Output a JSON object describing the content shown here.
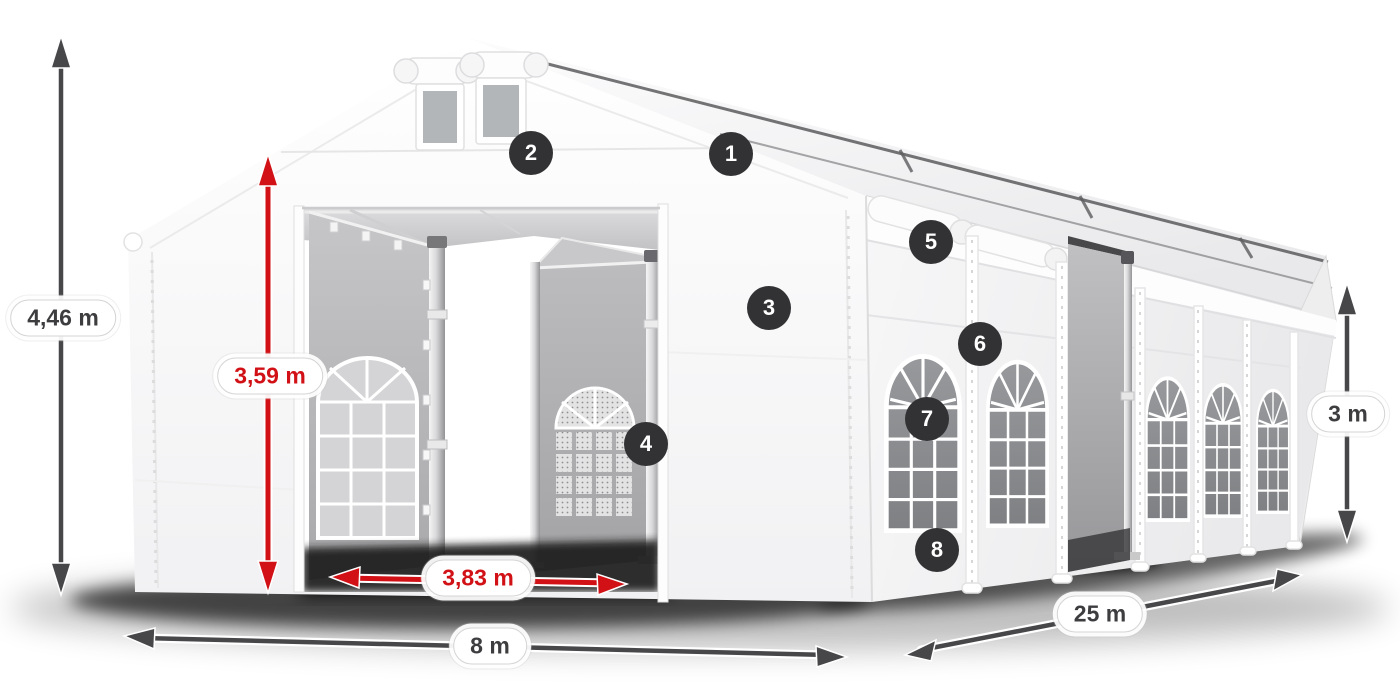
{
  "diagram": {
    "subject": "marquee tent with dimension annotations",
    "dimensions": [
      {
        "id": "total-height",
        "label": "4,46 m",
        "style": "gray"
      },
      {
        "id": "entrance-height",
        "label": "3,59 m",
        "style": "red"
      },
      {
        "id": "entrance-width",
        "label": "3,83 m",
        "style": "red"
      },
      {
        "id": "front-width",
        "label": "8 m",
        "style": "gray"
      },
      {
        "id": "side-length",
        "label": "25 m",
        "style": "gray"
      },
      {
        "id": "side-height",
        "label": "3 m",
        "style": "gray"
      }
    ],
    "callouts": [
      {
        "number": "1"
      },
      {
        "number": "2"
      },
      {
        "number": "3"
      },
      {
        "number": "4"
      },
      {
        "number": "5"
      },
      {
        "number": "6"
      },
      {
        "number": "7"
      },
      {
        "number": "8"
      }
    ],
    "colors": {
      "dimension_red": "#d11116",
      "dimension_gray": "#47474a",
      "badge_background": "#323234",
      "badge_text": "#ffffff",
      "fabric_white": "#fbfbfc",
      "tarpaulin_gray": "#b5b5b7",
      "window_glass_gray": "#8e9093"
    }
  }
}
